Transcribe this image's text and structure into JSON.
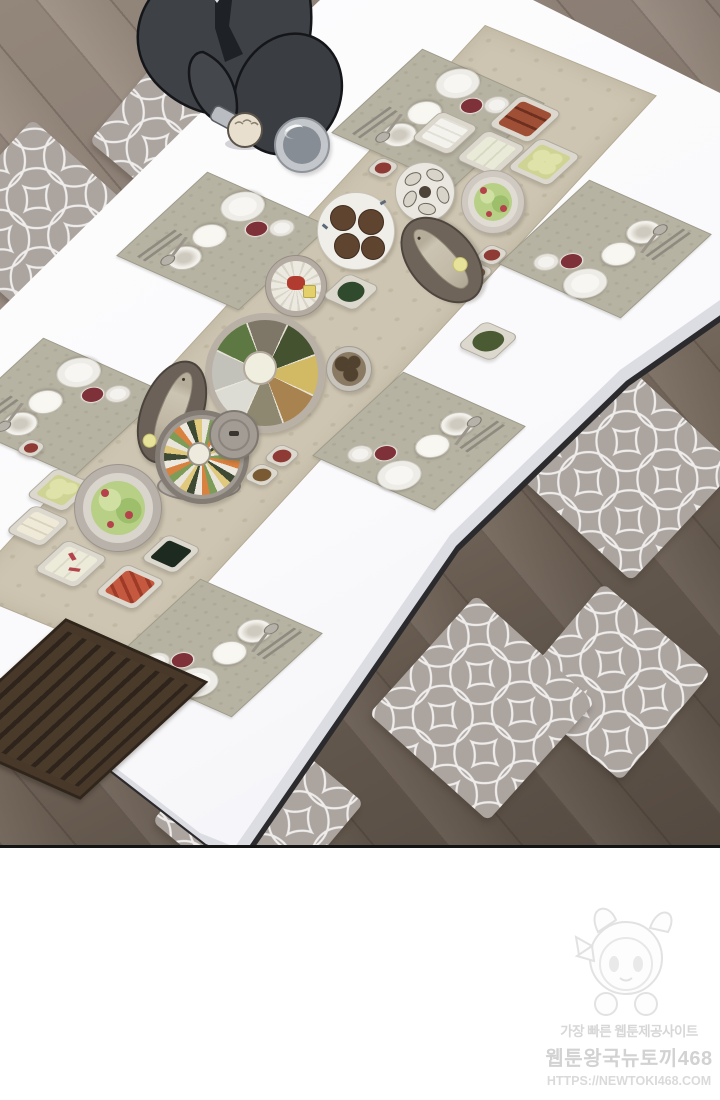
{
  "panel": {
    "description": "Webtoon panel: overhead view of a man in a dark suit kneeling on a patterned floor cushion at a long white Korean dining table set for six, with a beige runner of shared dishes (gujeolpan, whole fish platters, steamer, salads, jeon, kimchi, side dishes), grey quatrefoil floor cushions on dark wooden planks"
  },
  "watermark": {
    "line1": "가장 빠른 웹툰제공사이트",
    "line2": "웹툰왕국뉴토끼468",
    "line3": "HTTPS://NEWTOKI468.COM"
  },
  "palette": {
    "table_top": "#fbfbfd",
    "table_side": "#dcdce3",
    "runner": "#cdc5b1",
    "placemat": "#b7b3a3",
    "floor_light": "#9c8e82",
    "floor_dark": "#594e44",
    "cushion": "#aca49f",
    "cushion_pattern": "#ffffff",
    "suit": "#3e4146",
    "sauce_red": "#8e3a35",
    "panel_border": "#141414"
  },
  "scene": {
    "placemat_count": 6,
    "floor_cushion_count": 6,
    "place_setting_items": [
      "dinner-plate",
      "rice-bowl",
      "soup-bowl",
      "red-sauce-dish",
      "side-bowl",
      "spoon",
      "chopsticks"
    ],
    "shared_dishes": [
      "rice-cake-plate",
      "tofu-plate",
      "braised-fish-plate",
      "zucchini-plate",
      "oyster-plate",
      "salad-plate",
      "jeon-plate",
      "radial-slice-platter",
      "spinach-plate",
      "namul-plate",
      "gujeolpan-platter",
      "grilled-fish-platter",
      "steamed-fish-platter",
      "steamer-pot",
      "steamer-lid",
      "mushroom-bowl",
      "sauce-dishes",
      "zucchini-plate-2",
      "tofu-cube-plate",
      "salad-plate-2",
      "tofu-garnish-plate",
      "kimchi-plate",
      "seaweed-plate",
      "wooden-tray",
      "drinking-glass"
    ]
  }
}
